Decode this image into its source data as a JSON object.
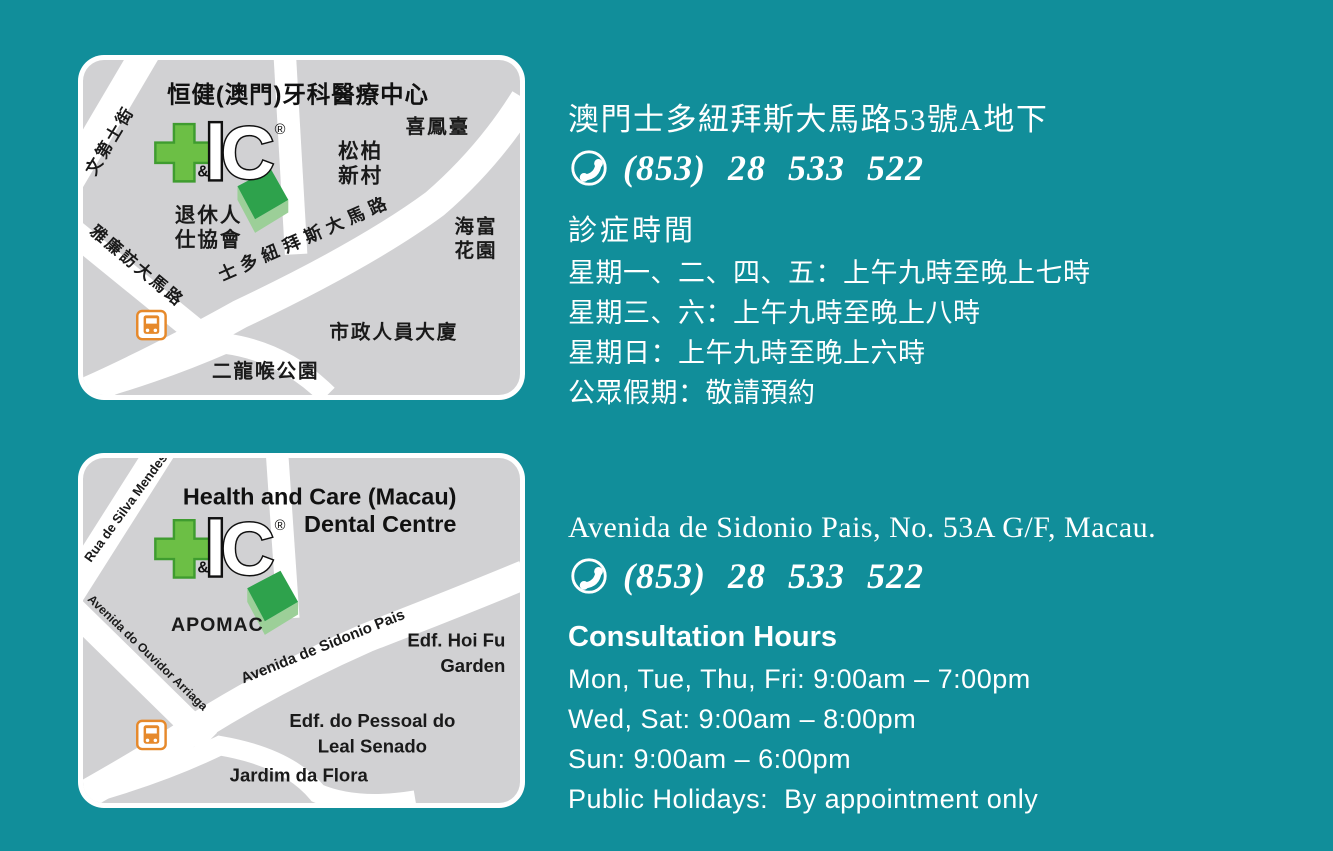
{
  "colors": {
    "background_teal": "#118E9A",
    "map_gray": "#D1D1D3",
    "road_white": "#FFFFFF",
    "logo_cross_green": "#6CBF45",
    "logo_cross_outline": "#3F9C2F",
    "building_green": "#2EA24C",
    "building_light_green": "#9CCF98",
    "bus_orange": "#E6892B",
    "text_white": "#FFFFFF",
    "map_text_black": "#1A1A1A"
  },
  "logo": {
    "ampersand": "&",
    "letters_i": "I",
    "letters_c": "C",
    "registered": "®"
  },
  "map_cn": {
    "title": "恒健(澳門)牙科醫療中心",
    "streets": {
      "s1": "文第士街",
      "s2": "雅廉訪大馬路",
      "s3": "士多紐拜斯大馬路"
    },
    "places": {
      "p1": "喜鳳臺",
      "p2a": "松柏",
      "p2b": "新村",
      "p3a": "退休人",
      "p3b": "仕協會",
      "p4a": "海富",
      "p4b": "花園",
      "p5": "市政人員大廈",
      "p6": "二龍喉公園"
    }
  },
  "map_en": {
    "title1": "Health and Care (Macau)",
    "title2": "Dental Centre",
    "streets": {
      "s1": "Rua de Silva Mendes",
      "s2": "Avenida do Ouvidor Arriaga",
      "s3": "Avenida de Sidonio Pais"
    },
    "places": {
      "p1": "APOMAC",
      "p2a": "Edf. Hoi Fu",
      "p2b": "Garden",
      "p3a": "Edf. do Pessoal do",
      "p3b": "Leal Senado",
      "p4": "Jardim da Flora"
    }
  },
  "info_cn": {
    "address": "澳門士多紐拜斯大馬路53號A地下",
    "phone": "(853) 28 533 522",
    "hours_title": "診症時間",
    "hours": [
      "星期一、二、四、五：上午九時至晚上七時",
      "星期三、六：上午九時至晚上八時",
      "星期日：上午九時至晚上六時",
      "公眾假期：敬請預約"
    ]
  },
  "info_en": {
    "address": "Avenida de Sidonio Pais, No. 53A G/F, Macau.",
    "phone": "(853) 28 533 522",
    "hours_title": "Consultation Hours",
    "hours": [
      "Mon, Tue, Thu, Fri: 9:00am – 7:00pm",
      "Wed, Sat: 9:00am – 8:00pm",
      "Sun: 9:00am – 6:00pm",
      "Public Holidays:  By appointment only"
    ]
  }
}
